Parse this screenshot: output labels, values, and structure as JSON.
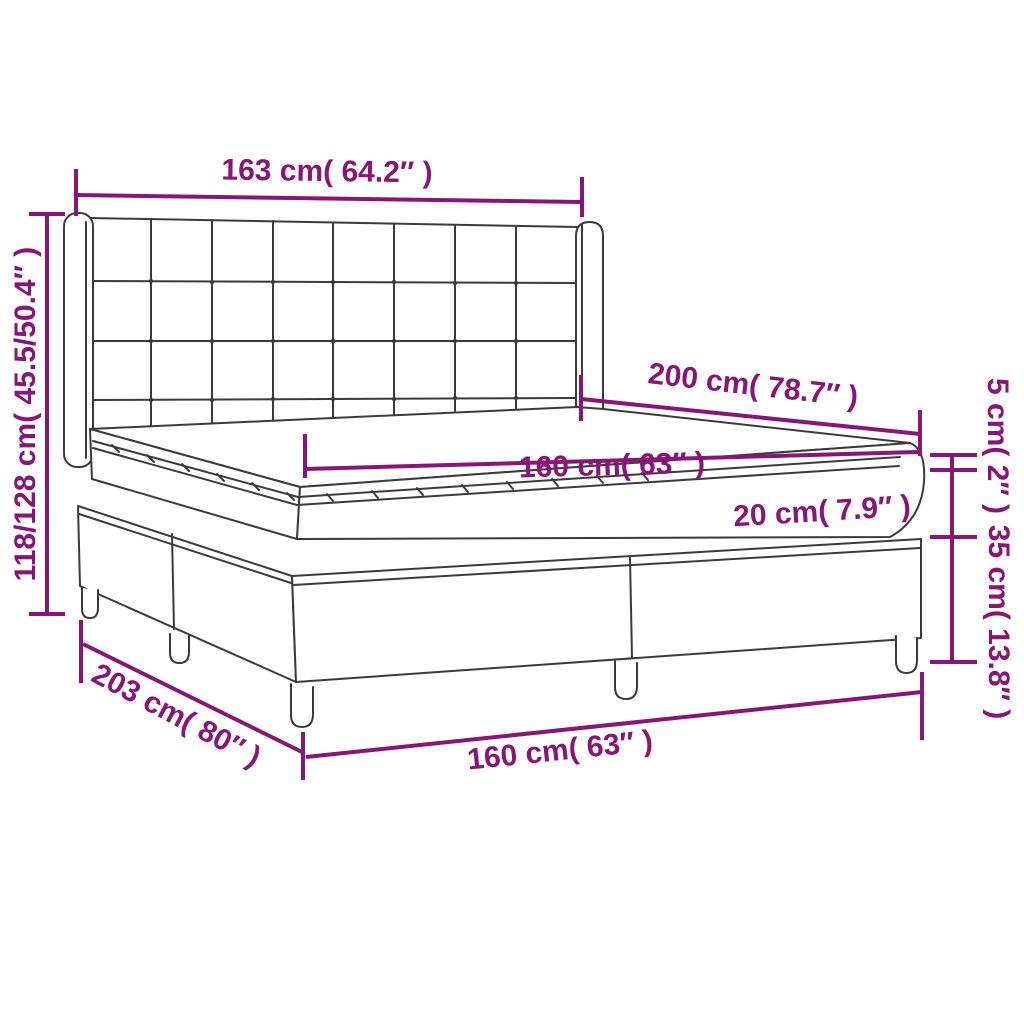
{
  "diagram": {
    "accent_color": "#8A1478",
    "line_color": "#3b3b3b",
    "background": "#ffffff",
    "labels": {
      "headboard_width": "163 cm( 64.2″ )",
      "overall_height": "118/128 cm( 45.5/50.4″ )",
      "bed_length": "200 cm( 78.7″ )",
      "mattress_width": "160 cm( 63″ )",
      "topper_thickness": "5 cm( 2″ )",
      "mattress_thickness": "20 cm( 7.9″ )",
      "base_height": "35 cm( 13.8″ )",
      "base_length": "203 cm( 80″ )",
      "base_width": "160 cm( 63″ )"
    }
  }
}
